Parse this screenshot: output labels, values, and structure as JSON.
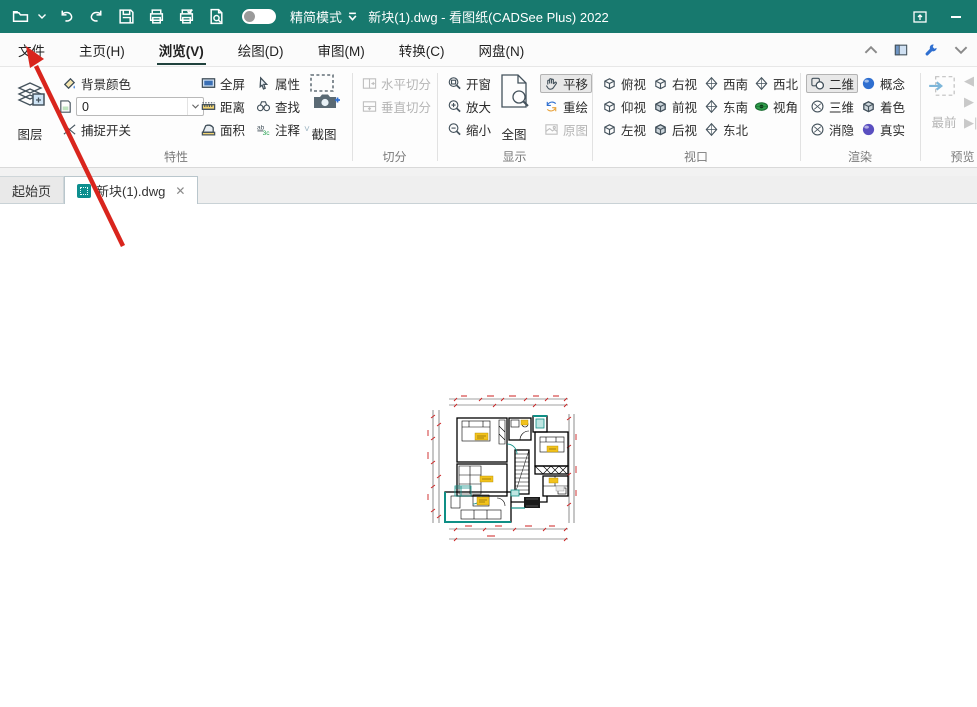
{
  "titlebar": {
    "title": "新块(1).dwg - 看图纸(CADSee Plus) 2022",
    "simple_mode_label": "精简模式"
  },
  "menubar": {
    "items": [
      {
        "label": "文件"
      },
      {
        "label": "主页(H)"
      },
      {
        "label": "浏览(V)"
      },
      {
        "label": "绘图(D)"
      },
      {
        "label": "审图(M)"
      },
      {
        "label": "转换(C)"
      },
      {
        "label": "网盘(N)"
      }
    ]
  },
  "ribbon": {
    "texing": {
      "label": "特性",
      "layers": "图层",
      "bg_color": "背景颜色",
      "color_value": "0",
      "snap_toggle": "捕捉开关",
      "fullscreen": "全屏",
      "distance": "距离",
      "area": "面积",
      "properties": "属性",
      "find": "查找",
      "annotate": "注释",
      "screenshot": "截图"
    },
    "qiefen": {
      "label": "切分",
      "split_h": "水平切分",
      "split_v": "垂直切分"
    },
    "xianshi": {
      "label": "显示",
      "zoom_window": "开窗",
      "zoom_in": "放大",
      "zoom_out": "缩小",
      "full_view": "全图",
      "pan": "平移",
      "redraw": "重绘",
      "original": "原图"
    },
    "shikou": {
      "label": "视口",
      "top": "俯视",
      "bottom": "仰视",
      "left": "左视",
      "right": "右视",
      "front": "前视",
      "back": "后视",
      "sw": "西南",
      "se": "东南",
      "ne": "东北",
      "nw": "西北",
      "angle": "视角"
    },
    "xuanran": {
      "label": "渲染",
      "d2": "二维",
      "d3": "三维",
      "hidden": "消隐",
      "concept": "概念",
      "shaded": "着色",
      "realistic": "真实"
    },
    "yulan": {
      "label": "预览",
      "front_most": "最前"
    }
  },
  "tabbar": {
    "tabs": [
      {
        "label": "起始页"
      },
      {
        "label": "新块(1).dwg"
      }
    ]
  },
  "colors": {
    "titlebar_teal": "#17796e",
    "arrow_red": "#d9251d",
    "drawing_teal": "#0f8f86",
    "drawing_dim_red": "#cc2222",
    "label_yellow": "#f2c21c",
    "icon_blue": "#2f6fd0"
  }
}
